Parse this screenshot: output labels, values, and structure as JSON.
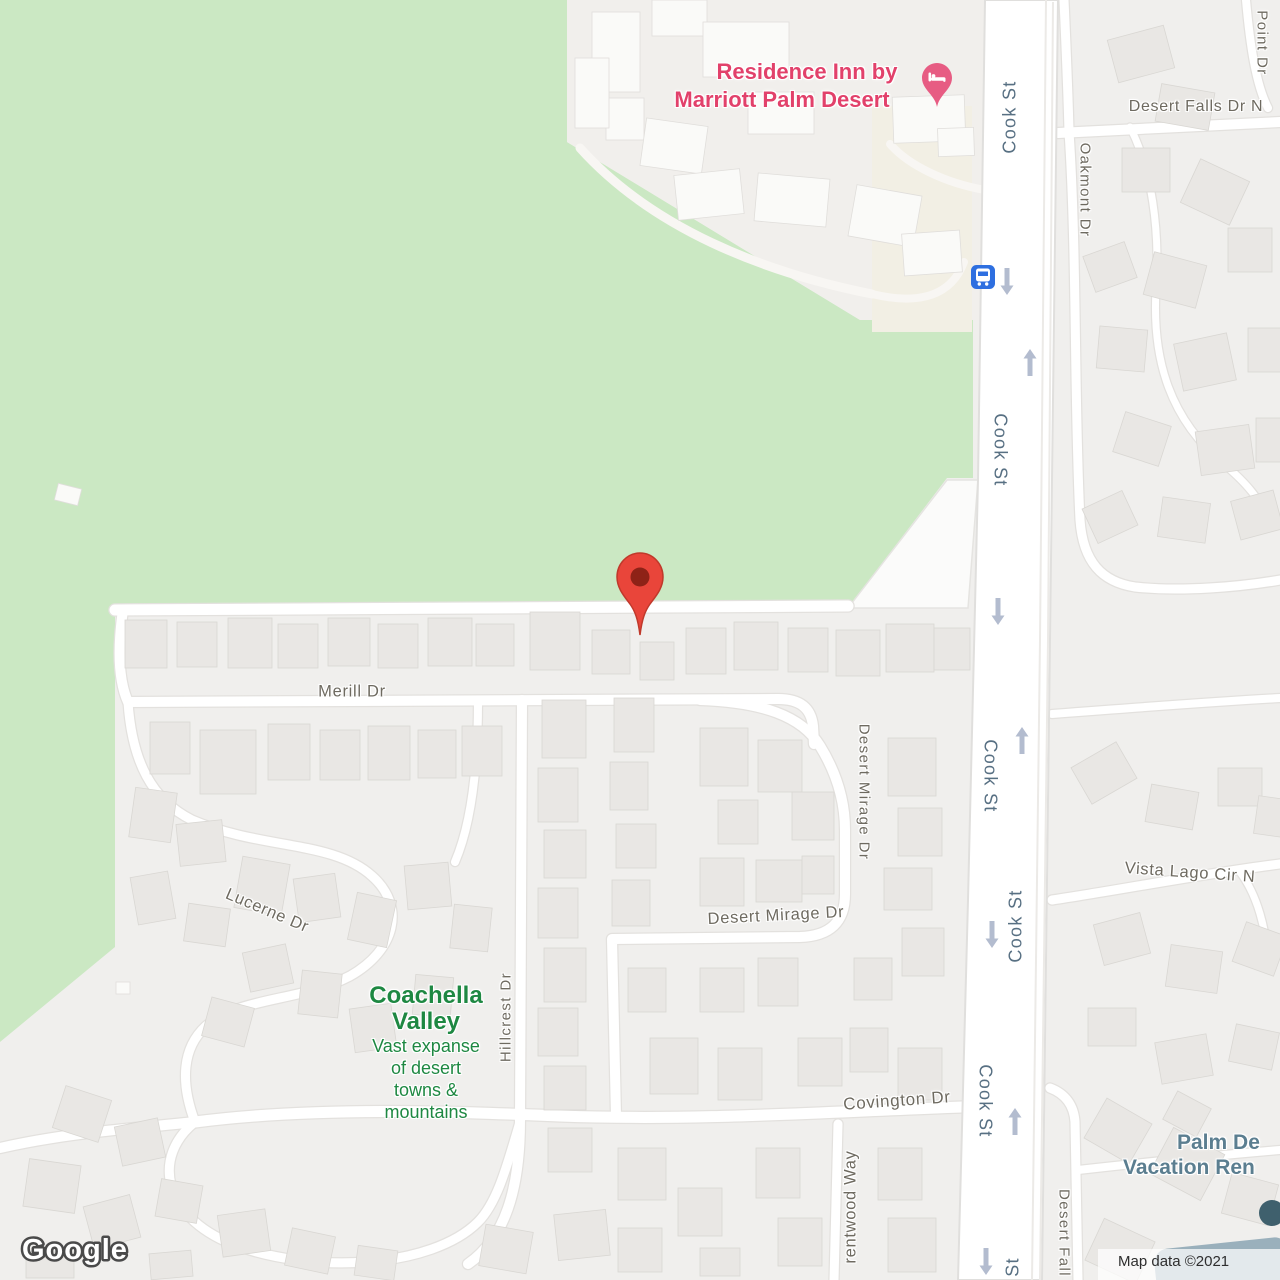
{
  "attribution": {
    "text": "Map data ©2021"
  },
  "logo": {
    "text": "Google"
  },
  "colors": {
    "park_green": "#cbe8c3",
    "land_gray": "#f0efed",
    "road_white": "#ffffff",
    "street_label": "#6e6a60",
    "highway_label": "#587083",
    "hotel_pink": "#e2416b",
    "nature_green": "#1e8842",
    "poi_blue": "#5b7e90",
    "pin_red": "#e9453a",
    "bus_blue": "#2e6fe0",
    "oneway_arrow": "#b3bccf"
  },
  "pois": {
    "residence_inn": {
      "label_line1": "Residence Inn by",
      "label_line2": "Marriott Palm Desert"
    },
    "coachella_valley": {
      "title_line1": "Coachella",
      "title_line2": "Valley",
      "desc_line1": "Vast expanse",
      "desc_line2": "of desert",
      "desc_line3": "towns &",
      "desc_line4": "mountains"
    },
    "vacation_rentals": {
      "label_line1": "Palm De",
      "label_line2": "Vacation Ren"
    }
  },
  "streets": {
    "cook_st": "Cook St",
    "cook_st_partial": "St",
    "merill_dr": "Merill Dr",
    "lucerne_dr": "Lucerne Dr",
    "hillcrest_dr": "Hillcrest Dr",
    "desert_mirage_dr": "Desert Mirage Dr",
    "covington_dr": "Covington Dr",
    "brentwood_way": "rentwood Way",
    "oakmont_dr": "Oakmont Dr",
    "desert_falls_dr_n": "Desert Falls Dr N",
    "desert_falls_partial": "Desert Fall",
    "point_dr": "Point Dr",
    "vista_lago_cir_n": "Vista Lago Cir N"
  }
}
